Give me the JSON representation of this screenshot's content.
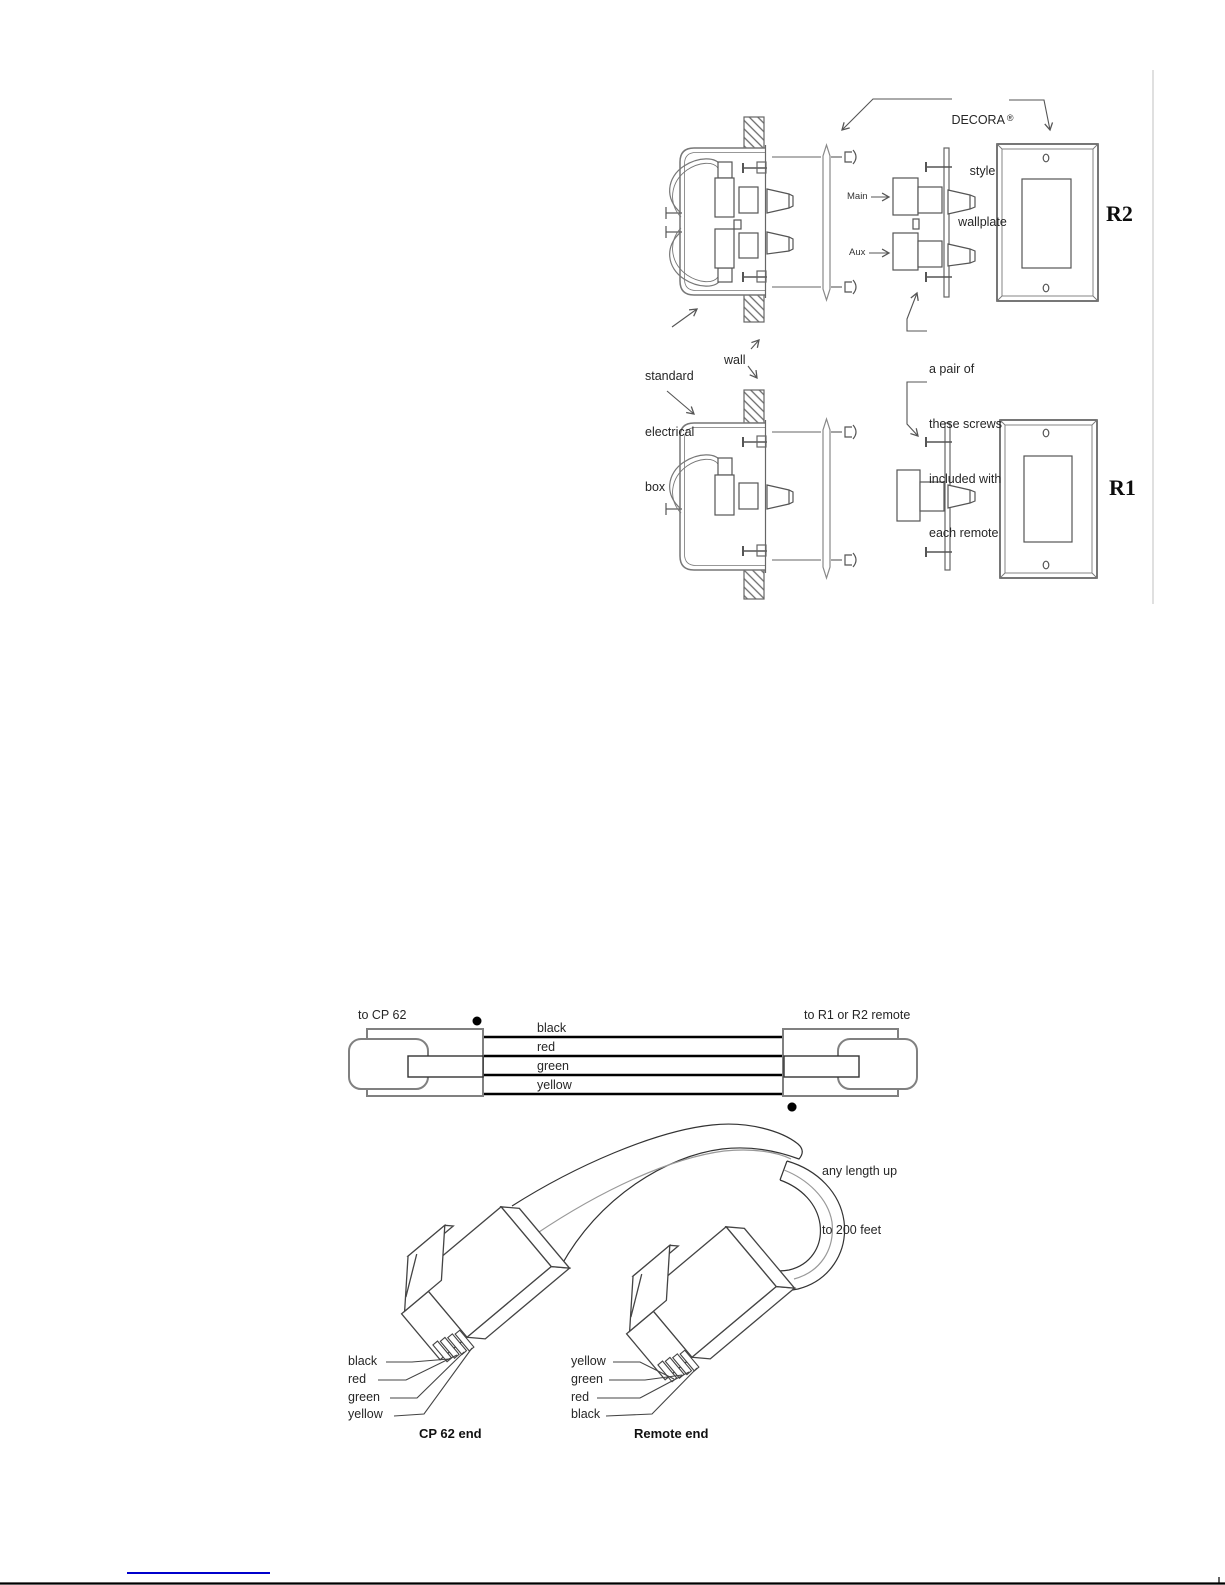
{
  "page": {
    "background": "#ffffff",
    "footer_link_color": "#0000cc"
  },
  "installation_diagram": {
    "wallplate_note": {
      "brand": "DECORA",
      "reg_mark": "®",
      "line2": "style",
      "line3": "wallplate"
    },
    "port_labels": {
      "main": "Main",
      "aux": "Aux"
    },
    "box_note": {
      "line1": "standard",
      "line2": "electrical",
      "line3": "box"
    },
    "wall_note": "wall",
    "screws_note": {
      "line1": "a pair of",
      "line2": "these screws",
      "line3": "included with",
      "line4": "each remote"
    },
    "remote_two_port_label": "R2",
    "remote_one_port_label": "R1"
  },
  "cable_schematic": {
    "left_label": "to CP 62",
    "right_label": "to R1 or R2 remote",
    "wire_labels": [
      "black",
      "red",
      "green",
      "yellow"
    ]
  },
  "cable_drawing": {
    "length_note_line1": "any length up",
    "length_note_line2": "to 200 feet",
    "cp62_pin_labels": [
      "black",
      "red",
      "green",
      "yellow"
    ],
    "remote_pin_labels": [
      "yellow",
      "green",
      "red",
      "black"
    ],
    "cp62_caption": "CP 62 end",
    "remote_caption": "Remote end"
  }
}
